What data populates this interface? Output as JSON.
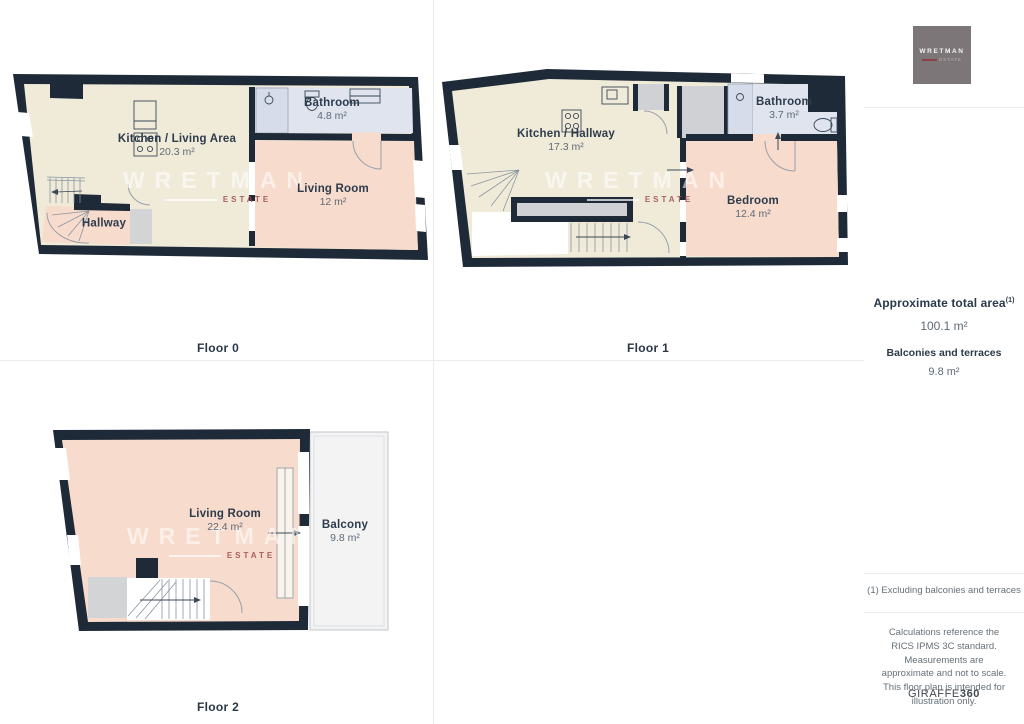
{
  "floors": [
    {
      "label": "Floor 0",
      "rooms": [
        {
          "name": "Kitchen / Living Area",
          "area": "20.3 m²"
        },
        {
          "name": "Bathroom",
          "area": "4.8 m²"
        },
        {
          "name": "Living Room",
          "area": "12 m²"
        },
        {
          "name": "Hallway",
          "area": ""
        }
      ]
    },
    {
      "label": "Floor 1",
      "rooms": [
        {
          "name": "Kitchen / Hallway",
          "area": "17.3 m²"
        },
        {
          "name": "Bathroom",
          "area": "3.7 m²"
        },
        {
          "name": "Bedroom",
          "area": "12.4 m²"
        }
      ]
    },
    {
      "label": "Floor 2",
      "rooms": [
        {
          "name": "Living Room",
          "area": "22.4 m²"
        },
        {
          "name": "Balcony",
          "area": "9.8 m²"
        }
      ]
    }
  ],
  "watermark": {
    "line1": "WRETMAN",
    "line2": "ESTATE"
  },
  "sidebar": {
    "logo": {
      "line1": "WRETMAN",
      "line2": "ESTATE"
    },
    "total": {
      "title": "Approximate total area",
      "sup": "(1)",
      "value": "100.1 m²"
    },
    "balconies": {
      "title": "Balconies and terraces",
      "value": "9.8 m²"
    },
    "footnote": "(1) Excluding balconies and terraces",
    "disclaimer": "Calculations reference the RICS IPMS 3C standard. Measurements are approximate and not to scale. This floor plan is intended for illustration only.",
    "brand": {
      "name": "GIRAFFE",
      "suffix": "360"
    }
  },
  "colors": {
    "wall": "#1e2a37",
    "cream": "#f0ebd9",
    "pink": "#f7dbcc",
    "bath_blue": "#dfe4ef",
    "shower_blue": "#d6dcea",
    "grey": "#d2d4d6",
    "accent_red": "#8f4045"
  }
}
